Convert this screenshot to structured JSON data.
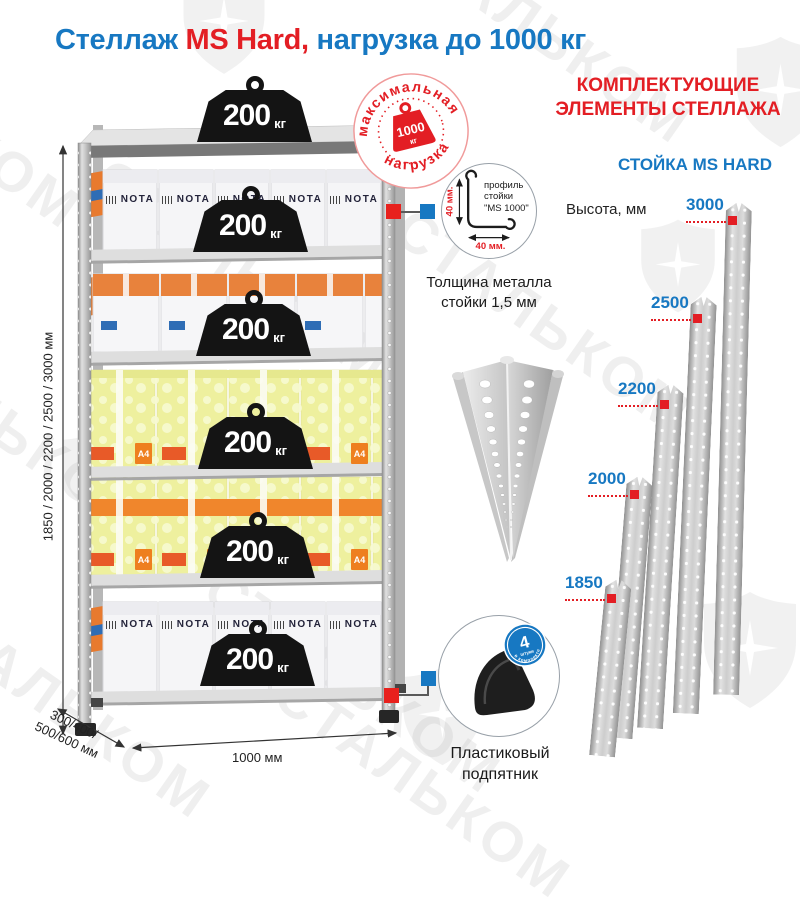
{
  "title": {
    "part1": "Стеллаж ",
    "part2": "MS Hard,",
    "part3": " нагрузка до 1000 кг"
  },
  "watermark": {
    "text": "СТАЛЬКОМ"
  },
  "colors": {
    "blue": "#1778c2",
    "red": "#e31e24"
  },
  "unit": {
    "weight_value": "200",
    "weight_unit": "кг",
    "nota_label": "NOTA",
    "a4_label": "A4",
    "dim_height": "1850 / 2000 / 2200 / 2500 / 3000 мм",
    "dim_depth_line1": "300/400/",
    "dim_depth_line2": "500/600 мм",
    "dim_width": "1000 мм"
  },
  "badge_max": {
    "top_text": "максимальная",
    "bottom_text": "нагрузка",
    "value": "1000",
    "unit": "кг"
  },
  "profile": {
    "dim_v": "40 мм.",
    "dim_h": "40 мм.",
    "label": "профиль стойки \"MS 1000\"",
    "caption": "Толщина металла стойки 1,5 мм"
  },
  "foot": {
    "badge_value": "4",
    "badge_line": "штуки",
    "badge_arc": "в комплекте",
    "caption": "Пластиковый подпятник"
  },
  "right": {
    "header1": "КОМПЛЕКТУЮЩИЕ",
    "header2": "ЭЛЕМЕНТЫ СТЕЛЛАЖА",
    "subheader": "СТОЙКА MS HARD",
    "height_label": "Высота, мм",
    "posts": [
      {
        "height": "3000"
      },
      {
        "height": "2500"
      },
      {
        "height": "2200"
      },
      {
        "height": "2000"
      },
      {
        "height": "1850"
      }
    ]
  }
}
